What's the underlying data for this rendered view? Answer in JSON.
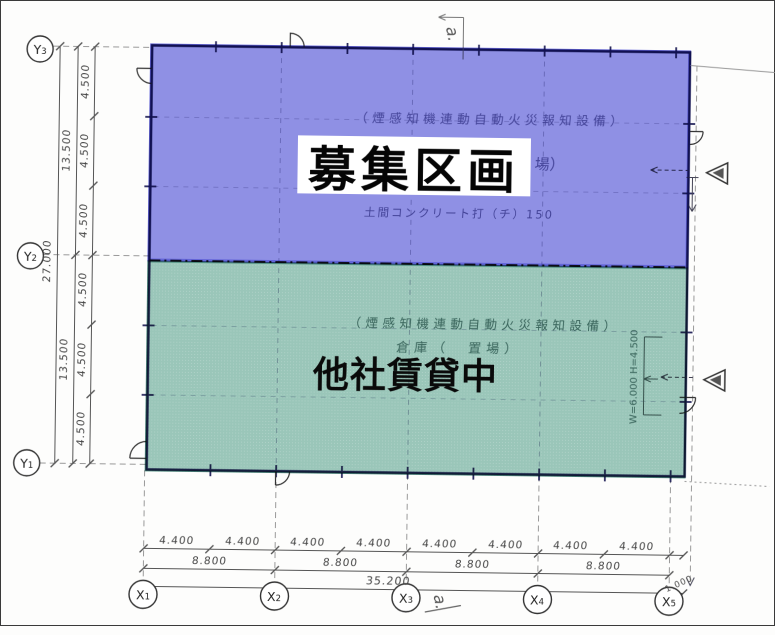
{
  "regions": {
    "available": {
      "label": "募集区画",
      "note_fire": "（煙感知機連動自動火災報知設備）",
      "note_floor": "土間コンクリート打（チ）150",
      "fragment": "場）",
      "highlight_color": "#8f90e4"
    },
    "leased": {
      "label": "他社賃貸中",
      "note_fire": "（煙感知機連動自動火災報知設備）",
      "note_use": "倉庫（　置場）",
      "door_note": "W=6.000 H=4.500",
      "highlight_color": "#9ac6b9"
    }
  },
  "grid": {
    "y": [
      {
        "letter": "Y",
        "sub": "3"
      },
      {
        "letter": "Y",
        "sub": "2"
      },
      {
        "letter": "Y",
        "sub": "1"
      }
    ],
    "x": [
      {
        "letter": "X",
        "sub": "1"
      },
      {
        "letter": "X",
        "sub": "2"
      },
      {
        "letter": "X",
        "sub": "3"
      },
      {
        "letter": "X",
        "sub": "4"
      },
      {
        "letter": "X",
        "sub": "5"
      }
    ]
  },
  "dims": {
    "left": {
      "overall": "27.000",
      "halves": [
        "13.500",
        "13.500"
      ],
      "segments": [
        "4.500",
        "4.500",
        "4.500",
        "4.500",
        "4.500",
        "4.500"
      ]
    },
    "bottom": {
      "segments": [
        "4.400",
        "4.400",
        "4.400",
        "4.400",
        "4.400",
        "4.400",
        "4.400",
        "4.400"
      ],
      "pairs": [
        "8.800",
        "8.800",
        "8.800",
        "8.800"
      ],
      "overall": "35.200",
      "offset": "1.000"
    }
  },
  "annotations": {
    "mark_top": "a.",
    "mark_bottom": "a."
  },
  "colors": {
    "wall_line": "#2a2a70",
    "dim_line": "#555555"
  }
}
